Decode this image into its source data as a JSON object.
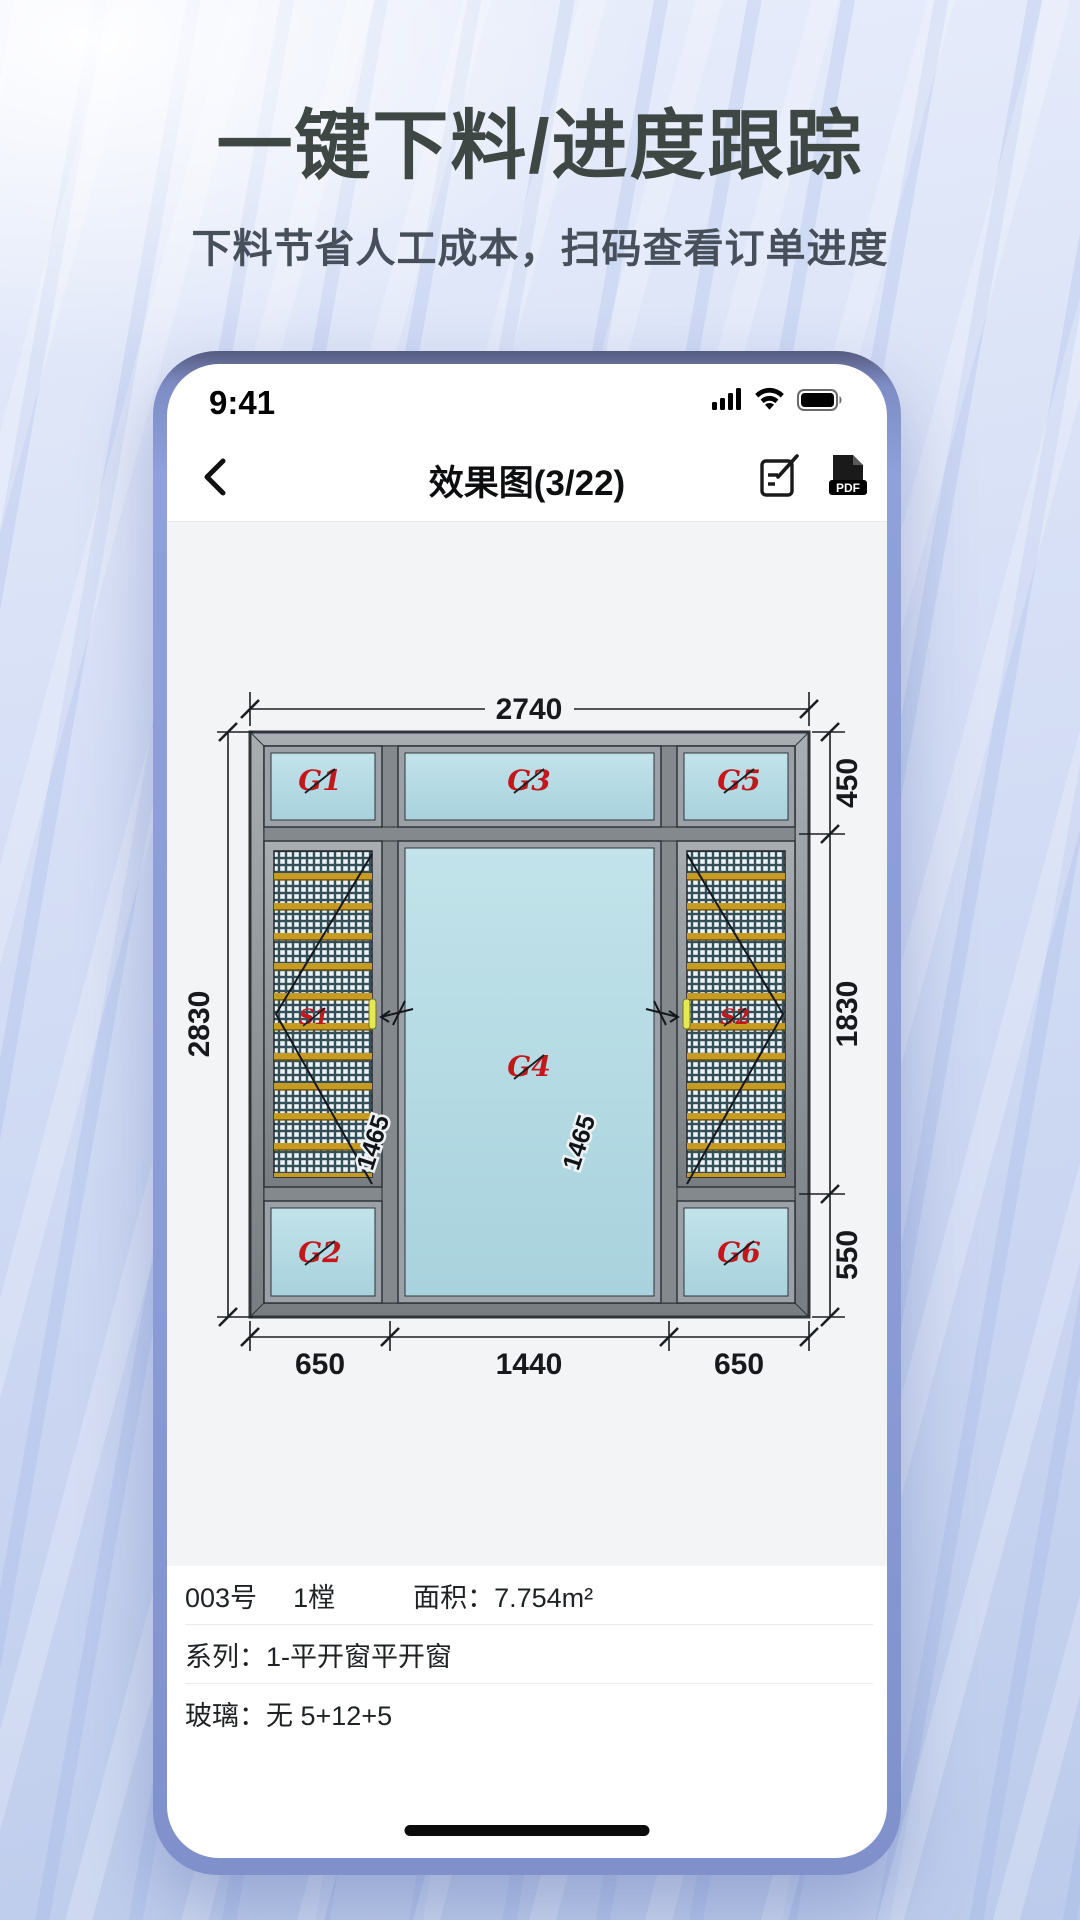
{
  "header": {
    "title": "一键下料/进度跟踪",
    "subtitle": "下料节省人工成本，扫码查看订单进度"
  },
  "phone": {
    "status": {
      "time": "9:41"
    },
    "nav": {
      "title": "效果图(3/22)",
      "pdf_label": "PDF"
    },
    "icons": {
      "back": "chevron-left-icon",
      "edit": "note-edit-icon",
      "pdf": "pdf-file-icon",
      "signal": "cellular-signal-icon",
      "wifi": "wifi-icon",
      "battery": "battery-full-icon",
      "home": "home-indicator-bar"
    },
    "diagram": {
      "dims": {
        "top": "2740",
        "left": "2830",
        "right_top": "450",
        "right_mid": "1830",
        "right_bottom": "550",
        "bottom_left": "650",
        "bottom_center": "1440",
        "bottom_right": "650",
        "sash_left": "1465",
        "sash_right": "1465"
      },
      "glass_labels": {
        "g1": "G1",
        "g2": "G2",
        "g3": "G3",
        "g4": "G4",
        "g5": "G5",
        "g6": "G6",
        "s1": "S1",
        "s2": "S2"
      },
      "colors": {
        "glass": "#b5dbe4",
        "frame": "#8e9297",
        "frame_dark": "#2f343a",
        "screen_mesh_dark": "#33505a",
        "screen_mesh_light": "#ecf3f5",
        "gold_bar": "#c79b21",
        "label_red": "#c4171c",
        "handle_yellow": "#e6ea52"
      }
    },
    "info": {
      "row1": {
        "no": "003号",
        "count": "1樘",
        "area": "面积：7.754m²"
      },
      "row2": "系列：1-平开窗平开窗",
      "row3": "玻璃：无 5+12+5"
    }
  }
}
